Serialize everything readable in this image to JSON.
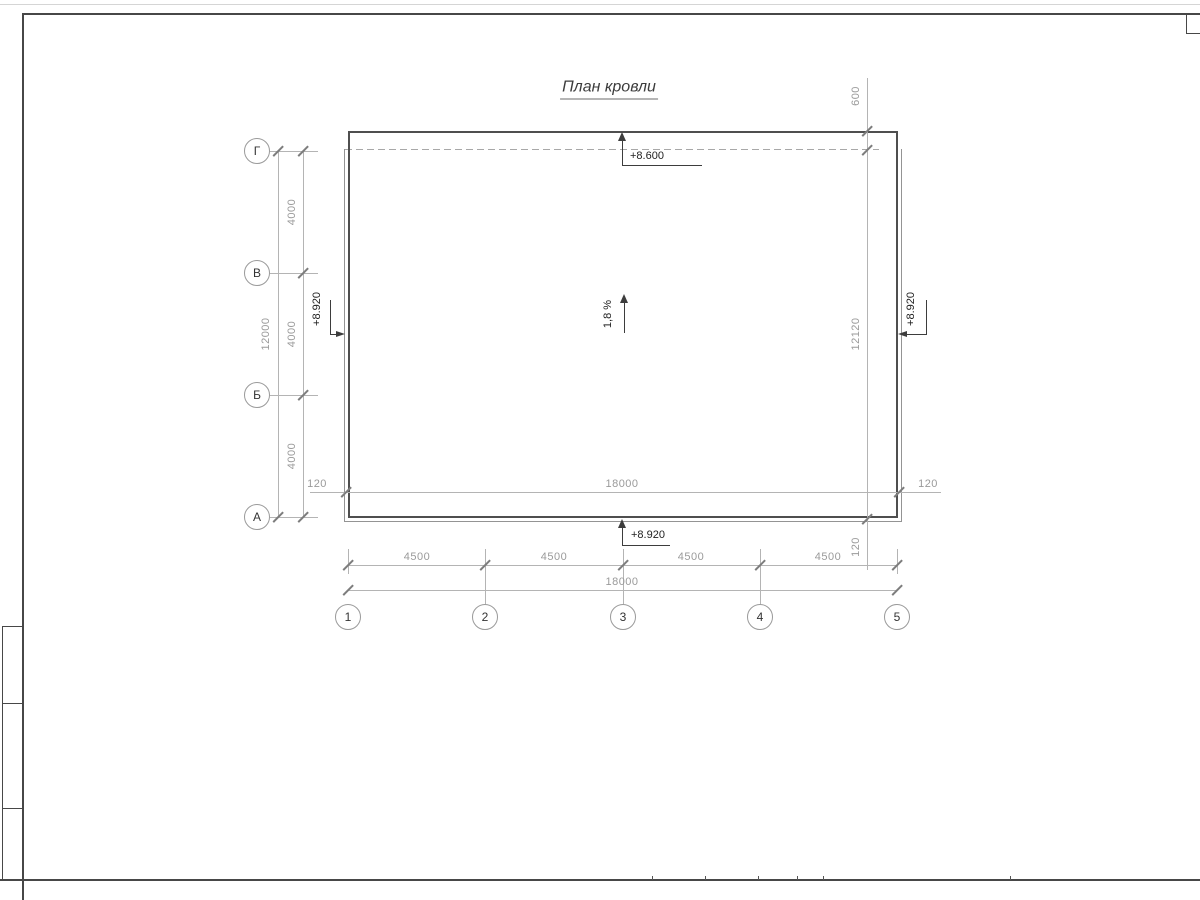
{
  "title": "План кровли",
  "axes": {
    "rows": [
      {
        "label": "Г"
      },
      {
        "label": "В"
      },
      {
        "label": "Б"
      },
      {
        "label": "А"
      }
    ],
    "cols": [
      {
        "label": "1"
      },
      {
        "label": "2"
      },
      {
        "label": "3"
      },
      {
        "label": "4"
      },
      {
        "label": "5"
      }
    ]
  },
  "dims": {
    "left": {
      "bays": [
        "4000",
        "4000",
        "4000"
      ],
      "total": "12000"
    },
    "inner": {
      "left_offset": "120",
      "total": "18000",
      "right_offset": "120"
    },
    "right": {
      "overhang_top": "600",
      "total": "12120",
      "overhang_bottom": "120"
    },
    "bottom": {
      "bays": [
        "4500",
        "4500",
        "4500",
        "4500"
      ],
      "total": "18000"
    }
  },
  "elev": {
    "top": "+8.600",
    "left": "+8.920",
    "right": "+8.920",
    "bottom": "+8.920"
  },
  "slope": {
    "label": "1,8 %"
  },
  "colors": {
    "roof_outline": "#4f4f4f",
    "dim_lines": "#b4b4b4",
    "dim_text": "#9a9a9a",
    "elev_text": "#222222"
  }
}
